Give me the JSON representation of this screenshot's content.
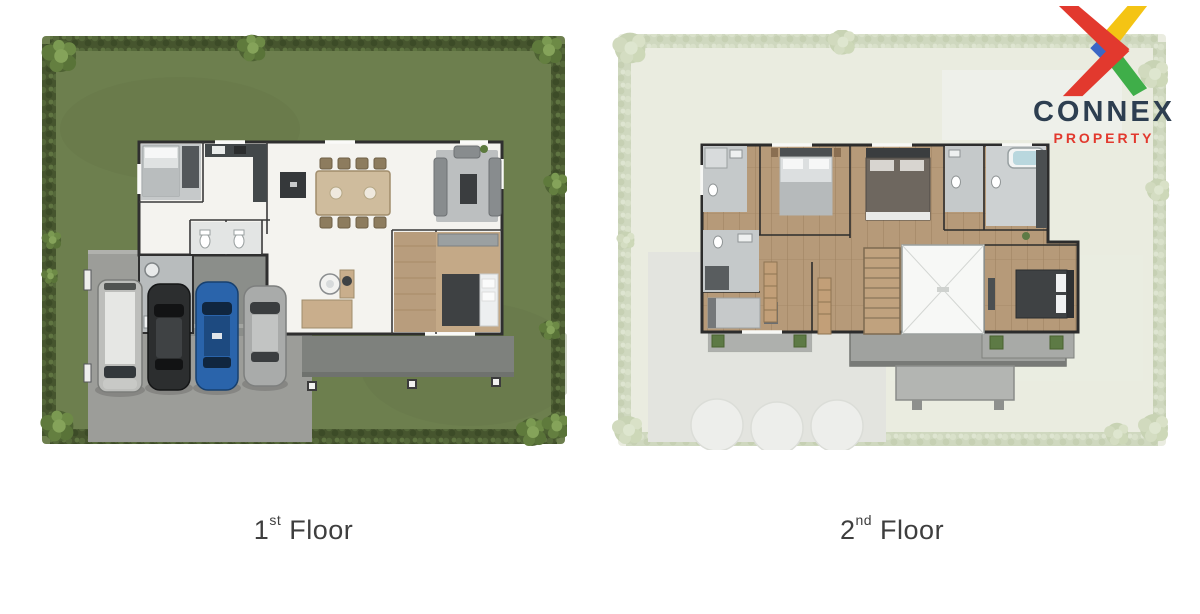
{
  "brand": {
    "name": "CONNEX",
    "tagline": "PROPERTY",
    "colors": {
      "red": "#e2392e",
      "yellow": "#f4c414",
      "green": "#3fae49",
      "blue": "#3b67c5",
      "navy": "#2d3e50"
    }
  },
  "floors": [
    {
      "id": "first",
      "number": "1",
      "ordinal": "st",
      "word": "Floor"
    },
    {
      "id": "second",
      "number": "2",
      "ordinal": "nd",
      "word": "Floor"
    }
  ],
  "plan_colors": {
    "lawn": "#6d7f4e",
    "hedge": "#46552e",
    "driveway": "#9c9d99",
    "terrace": "#7e817d",
    "floor_white": "#f4f3ef",
    "wood": "#b69a79",
    "wall": "#2f2f2f",
    "faded_lawn": "#e9ecdf"
  },
  "icons": {
    "logo": "connex-x-logo"
  }
}
